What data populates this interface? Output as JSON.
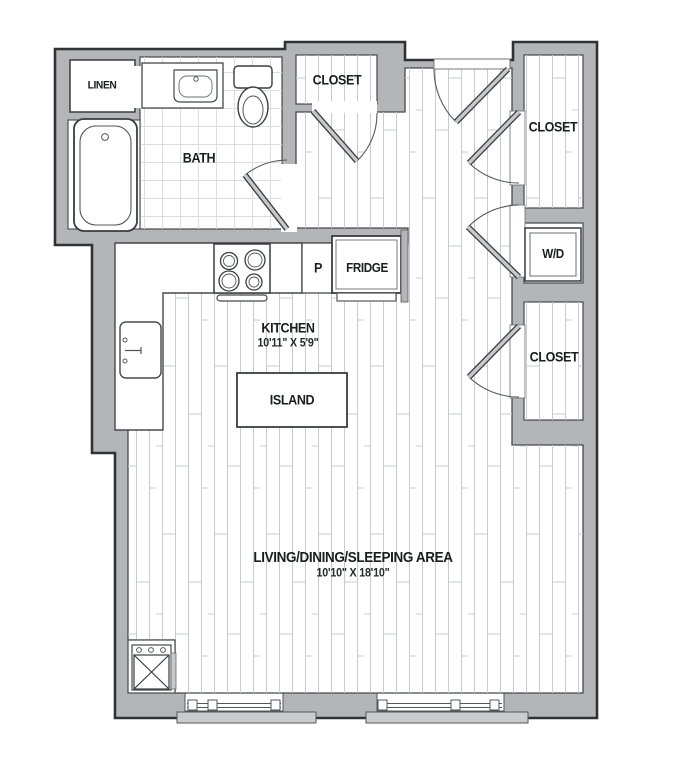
{
  "plan": {
    "title": "Studio floor plan",
    "rooms": {
      "linen": {
        "label": "LINEN"
      },
      "bath": {
        "label": "BATH"
      },
      "closet_top": {
        "label": "CLOSET"
      },
      "closet_right_upper": {
        "label": "CLOSET"
      },
      "wd": {
        "label": "W/D"
      },
      "closet_right_lower": {
        "label": "CLOSET"
      },
      "kitchen": {
        "label": "KITCHEN",
        "dimensions": "10'11\" X 5'9\""
      },
      "pantry": {
        "label": "P"
      },
      "fridge": {
        "label": "FRIDGE"
      },
      "island": {
        "label": "ISLAND"
      },
      "living": {
        "label": "LIVING/DINING/SLEEPING AREA",
        "dimensions": "10'10\" X 18'10\""
      }
    },
    "colors": {
      "wall": "#b3b5b8",
      "outline": "#303234",
      "inner_line": "#46484b",
      "plank_line": "#c9cbce",
      "tile_line": "#dcdee0",
      "sill": "#c9cbcd",
      "door_leaf": "#c6c8cb",
      "text": "#1b1d1f"
    }
  }
}
